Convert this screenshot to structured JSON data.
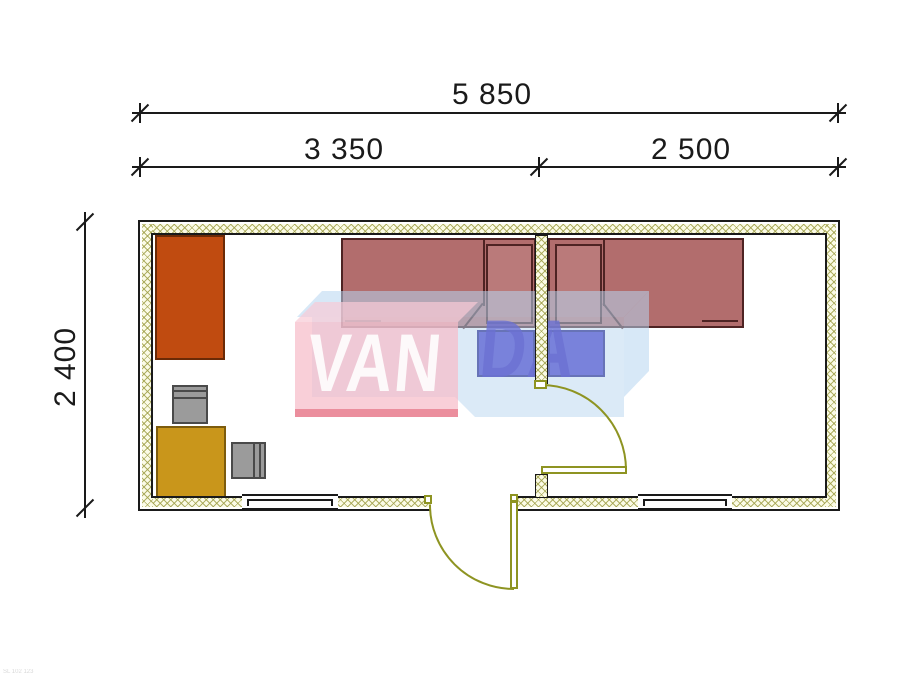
{
  "title": "Floor plan drawing",
  "dimensions": {
    "total_width_label": "5 850",
    "room_left_label": "3 350",
    "room_right_label": "2 500",
    "height_label": "2 400"
  },
  "plan": {
    "overall_mm": {
      "width": 5850,
      "depth": 2400
    },
    "rooms": [
      {
        "name": "room-left",
        "width_mm": 3350
      },
      {
        "name": "room-right",
        "width_mm": 2500
      }
    ],
    "furniture": [
      {
        "name": "wardrobe",
        "color": "#c04b10"
      },
      {
        "name": "desk",
        "color": "#c9961b"
      },
      {
        "name": "chair",
        "color": "#9b9b9b"
      },
      {
        "name": "chair",
        "color": "#9b9b9b"
      },
      {
        "name": "single-bed",
        "color": "#b26d6d"
      },
      {
        "name": "single-bed",
        "color": "#b26d6d"
      },
      {
        "name": "nightstand",
        "color": "#3b2fc6"
      },
      {
        "name": "nightstand",
        "color": "#3b2fc6"
      }
    ],
    "doors": 2,
    "windows": 2,
    "wall_hatch_color": "#9e9e46",
    "door_color": "#8e9422"
  },
  "watermark": {
    "text_front": "VAN",
    "text_side": "DA",
    "pink": "#f6bbc8",
    "light_blue": "#b7d6f0",
    "accent_red": "#e05a6e"
  },
  "corner_text": "SL 102 123"
}
